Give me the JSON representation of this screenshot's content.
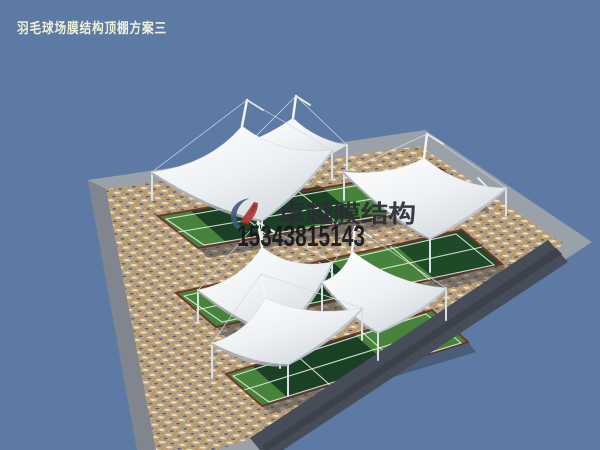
{
  "header": {
    "title": "羽毛球场膜结构顶棚方案三"
  },
  "watermark": {
    "brand": "卓越膜结构",
    "phone": "15343815143",
    "logo_icon": "swoosh-logo-icon"
  },
  "scene": {
    "type": "3d-architectural-render",
    "canopy_count": 6,
    "court_strip_count": 3,
    "colors": {
      "sky": "#5d7aa4",
      "membrane_white": "#f6f8fa",
      "membrane_shade": "#c9cfd6",
      "court_green": "#47833a",
      "court_shadow_green": "#1b4124",
      "mosaic_tan": "#c5aa81",
      "mosaic_accent_blue": "#56648c",
      "plaza_rim_gray": "#9ba1a9",
      "apron_dark_gray": "#474d58",
      "court_edging_maroon": "#703529",
      "title_text": "#eef1d8",
      "watermark_text": "#17181d",
      "logo_red": "#b5342f",
      "logo_blue": "#44597c"
    }
  }
}
